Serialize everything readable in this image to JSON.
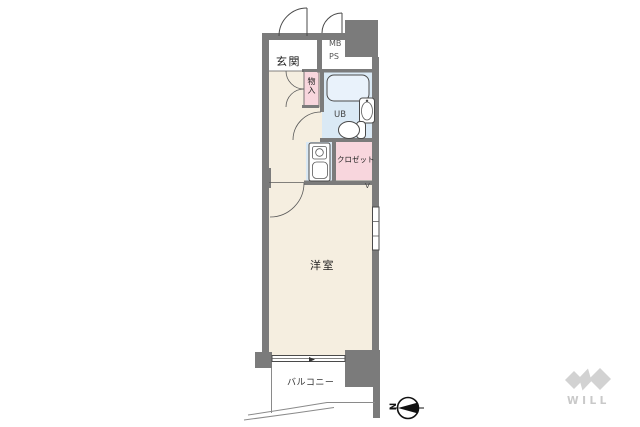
{
  "plan": {
    "entrance_label": "玄関",
    "mb_label": "MB",
    "ps_label": "PS",
    "storage_label": "物入",
    "unit_bath_label": "UB",
    "closet_label": "クロゼット",
    "western_room_label": "洋室",
    "balcony_label": "バルコニー",
    "vent_label": "V"
  },
  "compass": {
    "north_label": "N"
  },
  "brand": {
    "logo_text": "WILL"
  },
  "colors": {
    "wall_gray": "#7b7b7b",
    "floor_cream": "#f5eee0",
    "wet_area_blue": "#dae9f5",
    "storage_pink": "#f8d6dd",
    "room_white": "#ffffff",
    "bath_fill": "#e9f2fb",
    "outline_dark": "#4a4a4a",
    "compass_black": "#111111",
    "logo_gray": "#d2d2d2",
    "text_dark": "#222222"
  }
}
